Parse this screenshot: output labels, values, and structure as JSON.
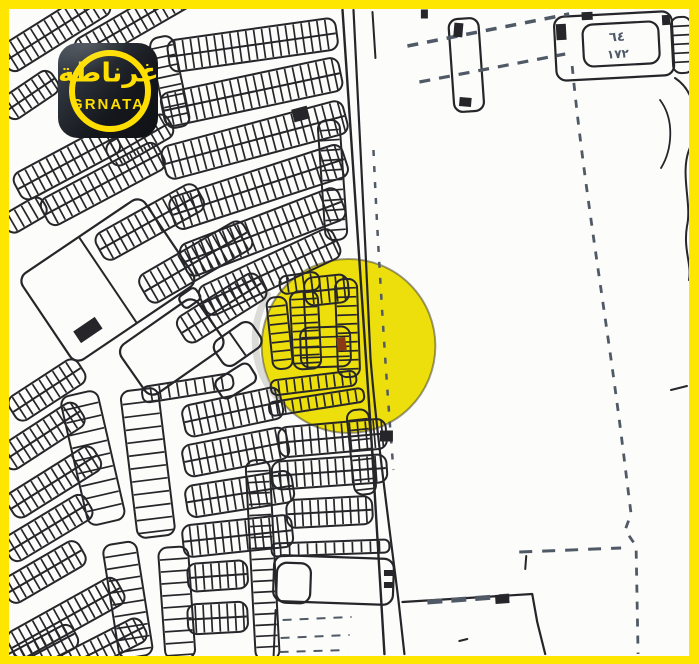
{
  "window": {
    "width": 699,
    "height": 664
  },
  "theme": {
    "frame": "#FFE600",
    "paper": "#FCFCFA",
    "line": "#26262a",
    "dash": "#505a66",
    "label": "#4e5a6a",
    "shadow": "#b9b9b4"
  },
  "logo": {
    "brand_ar": "غرناطة",
    "brand_en": "GRNATA",
    "accent": "#FFDE00",
    "bg_dark": "#14171c",
    "bg_light": "#454c57"
  },
  "map": {
    "highlight": {
      "cx": 349,
      "cy": 346,
      "r": 87,
      "fill": "#EDDF0C",
      "stroke_opacity": 0.45,
      "stroke_width": 2
    },
    "marker": {
      "cx": 342,
      "cy": 344,
      "w": 9,
      "h": 13,
      "a": -8,
      "fill": "#8A3A12"
    },
    "shadow_arc": {
      "d": "M268,295 A87,87 0 0 0 278,398",
      "w": 7,
      "o": 0.5
    },
    "strips": [
      {
        "cx": 55,
        "cy": 30,
        "l": 120,
        "w": 30,
        "a": -32,
        "t": "d"
      },
      {
        "cx": 135,
        "cy": 22,
        "l": 130,
        "w": 28,
        "a": -30,
        "t": "d"
      },
      {
        "cx": 30,
        "cy": 95,
        "l": 60,
        "w": 26,
        "a": -34,
        "t": "d"
      },
      {
        "cx": 67,
        "cy": 163,
        "l": 112,
        "w": 30,
        "a": -28,
        "t": "d"
      },
      {
        "cx": 103,
        "cy": 184,
        "l": 132,
        "w": 30,
        "a": -28,
        "t": "d"
      },
      {
        "cx": 140,
        "cy": 140,
        "l": 70,
        "w": 26,
        "a": -30,
        "t": "d"
      },
      {
        "cx": 25,
        "cy": 215,
        "l": 45,
        "w": 22,
        "a": -30,
        "t": "s"
      },
      {
        "cx": 170,
        "cy": 82,
        "l": 92,
        "w": 24,
        "a": 78,
        "t": "s",
        "rs": 10
      },
      {
        "cx": 253,
        "cy": 45,
        "l": 170,
        "w": 32,
        "a": -8,
        "t": "d"
      },
      {
        "cx": 252,
        "cy": 92,
        "l": 182,
        "w": 34,
        "a": -12,
        "t": "d"
      },
      {
        "cx": 255,
        "cy": 140,
        "l": 188,
        "w": 34,
        "a": -15,
        "t": "d"
      },
      {
        "cx": 259,
        "cy": 187,
        "l": 182,
        "w": 34,
        "a": -18,
        "t": "d"
      },
      {
        "cx": 263,
        "cy": 232,
        "l": 170,
        "w": 34,
        "a": -21,
        "t": "d"
      },
      {
        "cx": 270,
        "cy": 272,
        "l": 148,
        "w": 32,
        "a": -25,
        "t": "d"
      },
      {
        "cx": 333,
        "cy": 180,
        "l": 120,
        "w": 22,
        "a": 86,
        "t": "s",
        "rs": 10
      },
      {
        "cx": 150,
        "cy": 222,
        "l": 115,
        "w": 30,
        "a": -29,
        "t": "d"
      },
      {
        "cx": 196,
        "cy": 262,
        "l": 120,
        "w": 32,
        "a": -30,
        "t": "d"
      },
      {
        "cx": 222,
        "cy": 308,
        "l": 95,
        "w": 30,
        "a": -32,
        "t": "d"
      },
      {
        "cx": 47,
        "cy": 390,
        "l": 82,
        "w": 28,
        "a": -33,
        "t": "d"
      },
      {
        "cx": 42,
        "cy": 436,
        "l": 92,
        "w": 28,
        "a": -33,
        "t": "d"
      },
      {
        "cx": 54,
        "cy": 482,
        "l": 102,
        "w": 28,
        "a": -32,
        "t": "d"
      },
      {
        "cx": 48,
        "cy": 528,
        "l": 95,
        "w": 28,
        "a": -31,
        "t": "d"
      },
      {
        "cx": 44,
        "cy": 572,
        "l": 88,
        "w": 28,
        "a": -30,
        "t": "d"
      },
      {
        "cx": 66,
        "cy": 618,
        "l": 125,
        "w": 30,
        "a": -29,
        "t": "d"
      },
      {
        "cx": 40,
        "cy": 652,
        "l": 80,
        "w": 26,
        "a": -28,
        "t": "d"
      },
      {
        "cx": 95,
        "cy": 652,
        "l": 110,
        "w": 26,
        "a": -27,
        "t": "d"
      },
      {
        "cx": 93,
        "cy": 458,
        "l": 132,
        "w": 38,
        "a": 77,
        "t": "s",
        "rs": 13
      },
      {
        "cx": 148,
        "cy": 463,
        "l": 148,
        "w": 38,
        "a": 83,
        "t": "s",
        "rs": 13
      },
      {
        "cx": 128,
        "cy": 600,
        "l": 115,
        "w": 34,
        "a": 81,
        "t": "s",
        "rs": 12
      },
      {
        "cx": 177,
        "cy": 603,
        "l": 112,
        "w": 30,
        "a": 86,
        "t": "s",
        "rs": 12
      },
      {
        "cx": 188,
        "cy": 388,
        "l": 92,
        "w": 16,
        "a": -9,
        "t": "s",
        "rs": 9
      },
      {
        "cx": 233,
        "cy": 412,
        "l": 100,
        "w": 32,
        "a": -12,
        "t": "d"
      },
      {
        "cx": 236,
        "cy": 452,
        "l": 106,
        "w": 32,
        "a": -11,
        "t": "d"
      },
      {
        "cx": 240,
        "cy": 494,
        "l": 108,
        "w": 32,
        "a": -9,
        "t": "d"
      },
      {
        "cx": 238,
        "cy": 536,
        "l": 110,
        "w": 32,
        "a": -6,
        "t": "d"
      },
      {
        "cx": 218,
        "cy": 576,
        "l": 60,
        "w": 28,
        "a": -4,
        "t": "d"
      },
      {
        "cx": 218,
        "cy": 618,
        "l": 60,
        "w": 30,
        "a": -3,
        "t": "d"
      },
      {
        "cx": 280,
        "cy": 333,
        "l": 72,
        "w": 20,
        "a": 84,
        "t": "s",
        "rs": 9
      },
      {
        "cx": 306,
        "cy": 330,
        "l": 78,
        "w": 28,
        "a": 87,
        "t": "d",
        "rs": 8
      },
      {
        "cx": 348,
        "cy": 328,
        "l": 98,
        "w": 22,
        "a": 88,
        "t": "s",
        "rs": 9
      },
      {
        "cx": 327,
        "cy": 290,
        "l": 44,
        "w": 28,
        "a": -6,
        "t": "d",
        "rs": 8
      },
      {
        "cx": 326,
        "cy": 347,
        "l": 40,
        "w": 50,
        "a": 88,
        "t": "s",
        "rs": 10
      },
      {
        "cx": 300,
        "cy": 283,
        "l": 40,
        "w": 18,
        "a": -8,
        "t": "s",
        "rs": 8
      },
      {
        "cx": 314,
        "cy": 383,
        "l": 86,
        "w": 15,
        "a": -7,
        "t": "s",
        "rs": 8
      },
      {
        "cx": 317,
        "cy": 402,
        "l": 96,
        "w": 14,
        "a": -9,
        "t": "s",
        "rs": 8
      },
      {
        "cx": 362,
        "cy": 452,
        "l": 85,
        "w": 22,
        "a": 84,
        "t": "s",
        "rs": 10
      },
      {
        "cx": 263,
        "cy": 560,
        "l": 200,
        "w": 24,
        "a": 87,
        "t": "s",
        "rs": 11
      },
      {
        "cx": 333,
        "cy": 438,
        "l": 108,
        "w": 30,
        "a": -5,
        "t": "d",
        "rs": 8
      },
      {
        "cx": 330,
        "cy": 472,
        "l": 115,
        "w": 28,
        "a": -4,
        "t": "d",
        "rs": 8
      },
      {
        "cx": 330,
        "cy": 512,
        "l": 86,
        "w": 28,
        "a": -3,
        "t": "d",
        "rs": 8
      },
      {
        "cx": 331,
        "cy": 548,
        "l": 118,
        "w": 13,
        "a": -2,
        "t": "s",
        "rs": 9
      },
      {
        "cx": 683,
        "cy": 45,
        "l": 56,
        "w": 20,
        "a": 87,
        "t": "s",
        "rs": 9
      }
    ],
    "parcels": [
      {
        "cx": 108,
        "cy": 280,
        "l": 148,
        "w": 104,
        "a": -34,
        "div": 1
      },
      {
        "cx": 172,
        "cy": 347,
        "l": 94,
        "w": 60,
        "a": -35,
        "div": 0
      },
      {
        "cx": 190,
        "cy": 298,
        "l": 20,
        "w": 14,
        "a": -35,
        "div": 0
      },
      {
        "cx": 238,
        "cy": 344,
        "l": 46,
        "w": 30,
        "a": -35,
        "div": 1
      },
      {
        "cx": 236,
        "cy": 381,
        "l": 40,
        "w": 22,
        "a": -32,
        "div": 0
      },
      {
        "cx": 334,
        "cy": 580,
        "l": 120,
        "w": 46,
        "a": 2,
        "div": 0
      },
      {
        "cx": 294,
        "cy": 583,
        "l": 34,
        "w": 40,
        "a": 2,
        "div": 0
      },
      {
        "cx": 615,
        "cy": 46,
        "l": 118,
        "w": 64,
        "a": -3,
        "div": 0
      },
      {
        "cx": 622,
        "cy": 44,
        "l": 76,
        "w": 42,
        "a": -3,
        "div": 0
      },
      {
        "cx": 467,
        "cy": 65,
        "l": 93,
        "w": 30,
        "a": 86,
        "div": 0
      }
    ],
    "dark_rects": [
      {
        "cx": 88,
        "cy": 330,
        "w": 26,
        "h": 14,
        "a": -34
      },
      {
        "cx": 301,
        "cy": 114,
        "w": 16,
        "h": 13,
        "a": -15
      },
      {
        "cx": 562,
        "cy": 32,
        "w": 10,
        "h": 16,
        "a": -3
      },
      {
        "cx": 588,
        "cy": 16,
        "w": 11,
        "h": 8,
        "a": -3
      },
      {
        "cx": 667,
        "cy": 20,
        "w": 8,
        "h": 10,
        "a": -3
      },
      {
        "cx": 459,
        "cy": 30,
        "w": 9,
        "h": 14,
        "a": 5
      },
      {
        "cx": 466,
        "cy": 102,
        "w": 12,
        "h": 9,
        "a": 5
      },
      {
        "cx": 387,
        "cy": 436,
        "w": 13,
        "h": 11,
        "a": 0
      },
      {
        "cx": 389,
        "cy": 573,
        "w": 9,
        "h": 6,
        "a": 0
      },
      {
        "cx": 389,
        "cy": 585,
        "w": 9,
        "h": 6,
        "a": 0
      },
      {
        "cx": 503,
        "cy": 599,
        "w": 14,
        "h": 9,
        "a": -4
      },
      {
        "cx": 425,
        "cy": 14,
        "w": 7,
        "h": 9,
        "a": 0
      }
    ],
    "lines": [
      {
        "d": "M343,10 C352,160 362,300 372,440 C378,540 383,612 385,654",
        "w": 2.4
      },
      {
        "d": "M354,10 C359,100 363,180 366,250 C368,300 370,330 371,358",
        "w": 2.2
      },
      {
        "d": "M371,358 C377,432 389,520 399,600 L405,654",
        "w": 2.2
      },
      {
        "d": "M373,12 L376,58",
        "w": 2
      },
      {
        "d": "M403,602 L533,594 L538,622 L546,654",
        "w": 2.2
      },
      {
        "d": "M676,78 C700,94 699,128 690,150 C681,174 693,204 688,226 C684,250 693,264 690,280",
        "w": 2
      },
      {
        "d": "M661,100 C676,120 673,150 662,168",
        "w": 1.8
      },
      {
        "d": "M672,390 L688,386",
        "w": 2
      },
      {
        "d": "M527,556 L526,569",
        "w": 2
      },
      {
        "d": "M460,641 L468,639",
        "w": 2
      },
      {
        "d": "M276,610 L274,656",
        "w": 2
      }
    ],
    "dashes": [
      {
        "d": "M408,46 L570,14",
        "w": 3.5,
        "p": "11 9"
      },
      {
        "d": "M420,82 L566,54",
        "w": 3.2,
        "p": "11 9"
      },
      {
        "d": "M573,66 C585,190 608,320 624,450 L632,514 L626,530 L637,546 L639,654",
        "w": 2.8,
        "p": "8 9"
      },
      {
        "d": "M374,150 C379,260 386,370 394,470",
        "w": 2.5,
        "p": "6 10"
      },
      {
        "d": "M520,552 L622,548",
        "w": 3,
        "p": "13 10"
      },
      {
        "d": "M428,602 L510,596",
        "w": 5,
        "p": "15 9"
      },
      {
        "d": "M283,620 L352,617",
        "w": 2,
        "p": "9 8"
      },
      {
        "d": "M281,638 L350,635",
        "w": 2,
        "p": "9 8"
      },
      {
        "d": "M280,652 L348,650",
        "w": 2,
        "p": "9 8"
      }
    ],
    "labels": [
      {
        "text": "٦٤",
        "x": 618,
        "y": 41,
        "size": 13,
        "a": -3
      },
      {
        "text": "١٧٢",
        "x": 619,
        "y": 58,
        "size": 12,
        "a": -3
      }
    ]
  }
}
